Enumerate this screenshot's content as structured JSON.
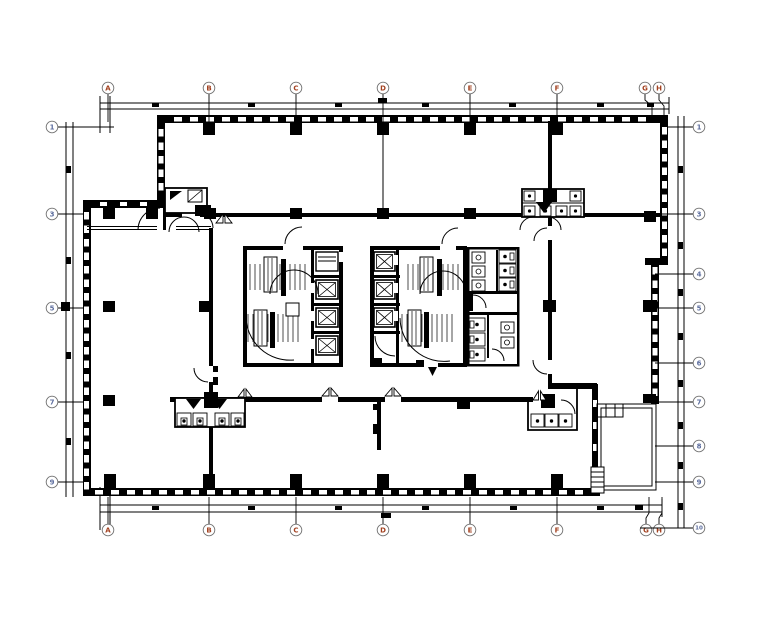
{
  "drawing": {
    "background": "#ffffff",
    "line_color": "#000000",
    "wall_color": "#000000",
    "axis_letter_color": "#a2401f",
    "axis_number_color": "#5c6d9e",
    "bubble_stroke": "#6f6f6f",
    "top_axis": {
      "labels": [
        "A",
        "B",
        "C",
        "D",
        "E",
        "F",
        "G",
        "H"
      ],
      "x": [
        108,
        209,
        296,
        383,
        470,
        557,
        645,
        659
      ],
      "circle_y": 88
    },
    "bottom_axis": {
      "labels": [
        "A",
        "B",
        "C",
        "D",
        "E",
        "F",
        "G",
        "H"
      ],
      "x": [
        108,
        209,
        296,
        383,
        470,
        557,
        646,
        659
      ],
      "circle_y": 530
    },
    "left_axis": {
      "labels": [
        "1",
        "3",
        "5",
        "7",
        "9"
      ],
      "y": [
        127,
        214,
        308,
        402,
        482
      ],
      "circle_x": 52
    },
    "right_axis": {
      "labels": [
        "1",
        "3",
        "4",
        "5",
        "6",
        "7",
        "8",
        "9",
        "10"
      ],
      "y": [
        127,
        214,
        274,
        308,
        363,
        402,
        446,
        482,
        528
      ],
      "circle_x": 699
    },
    "symbols": {
      "elevator_icon": "crossed-box",
      "stair_icon": "tread-lines-with-arc",
      "column_icon": "solid-square",
      "double_door_icon": "bowtie-triangles",
      "door_icon": "quarter-arc-swing",
      "window_icon": "wall-slots",
      "toilet_icon": "cell-with-dot",
      "sink_icon": "box-with-circle"
    }
  }
}
